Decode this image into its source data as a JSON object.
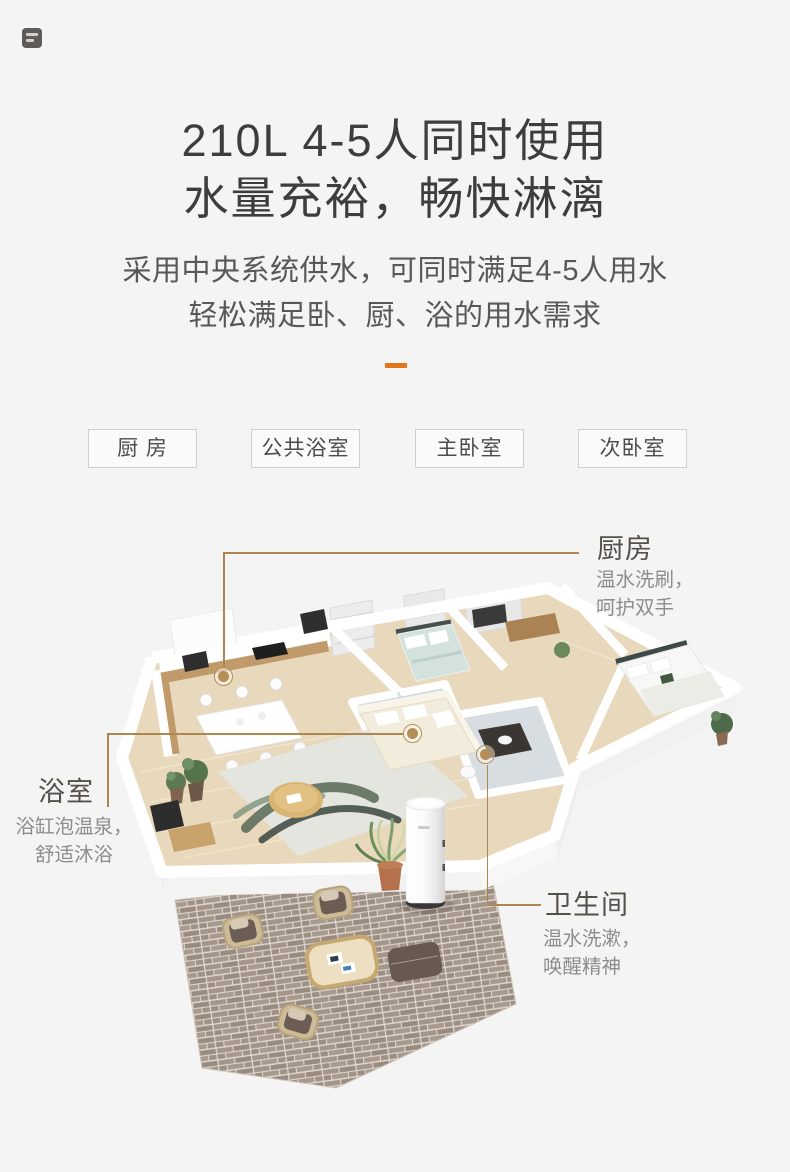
{
  "hero": {
    "title_line1": "210L 4-5人同时使用",
    "title_line2": "水量充裕，畅快淋漓",
    "subtitle_line1": "采用中央系统供水，可同时满足4-5人用水",
    "subtitle_line2": "轻松满足卧、厨、浴的用水需求"
  },
  "room_tags": [
    {
      "label": "厨 房"
    },
    {
      "label": "公共浴室"
    },
    {
      "label": "主卧室"
    },
    {
      "label": "次卧室"
    }
  ],
  "annotations": {
    "kitchen": {
      "title": "厨房",
      "line1": "温水洗刷，",
      "line2": "呵护双手"
    },
    "bathroom": {
      "title": "浴室",
      "line1": "浴缸泡温泉，",
      "line2": "舒适沐浴"
    },
    "toilet": {
      "title": "卫生间",
      "line1": "温水洗漱，",
      "line2": "唤醒精神"
    }
  },
  "colors": {
    "page_bg": "#f4f4f4",
    "accent_orange": "#e2761a",
    "title_text": "#3d3d3d",
    "subtitle_text": "#585858",
    "tag_border": "#cfcfcf",
    "tag_text": "#4c4c4c",
    "annotation_heading": "#55504a",
    "annotation_body": "#8d8d8d",
    "annotation_line": "#ad8750",
    "annotation_dot": "#b48e54",
    "wood_floor": "#e8d8bc",
    "brick_patio": "#a3958a",
    "water_heater_body": "#ffffff"
  }
}
